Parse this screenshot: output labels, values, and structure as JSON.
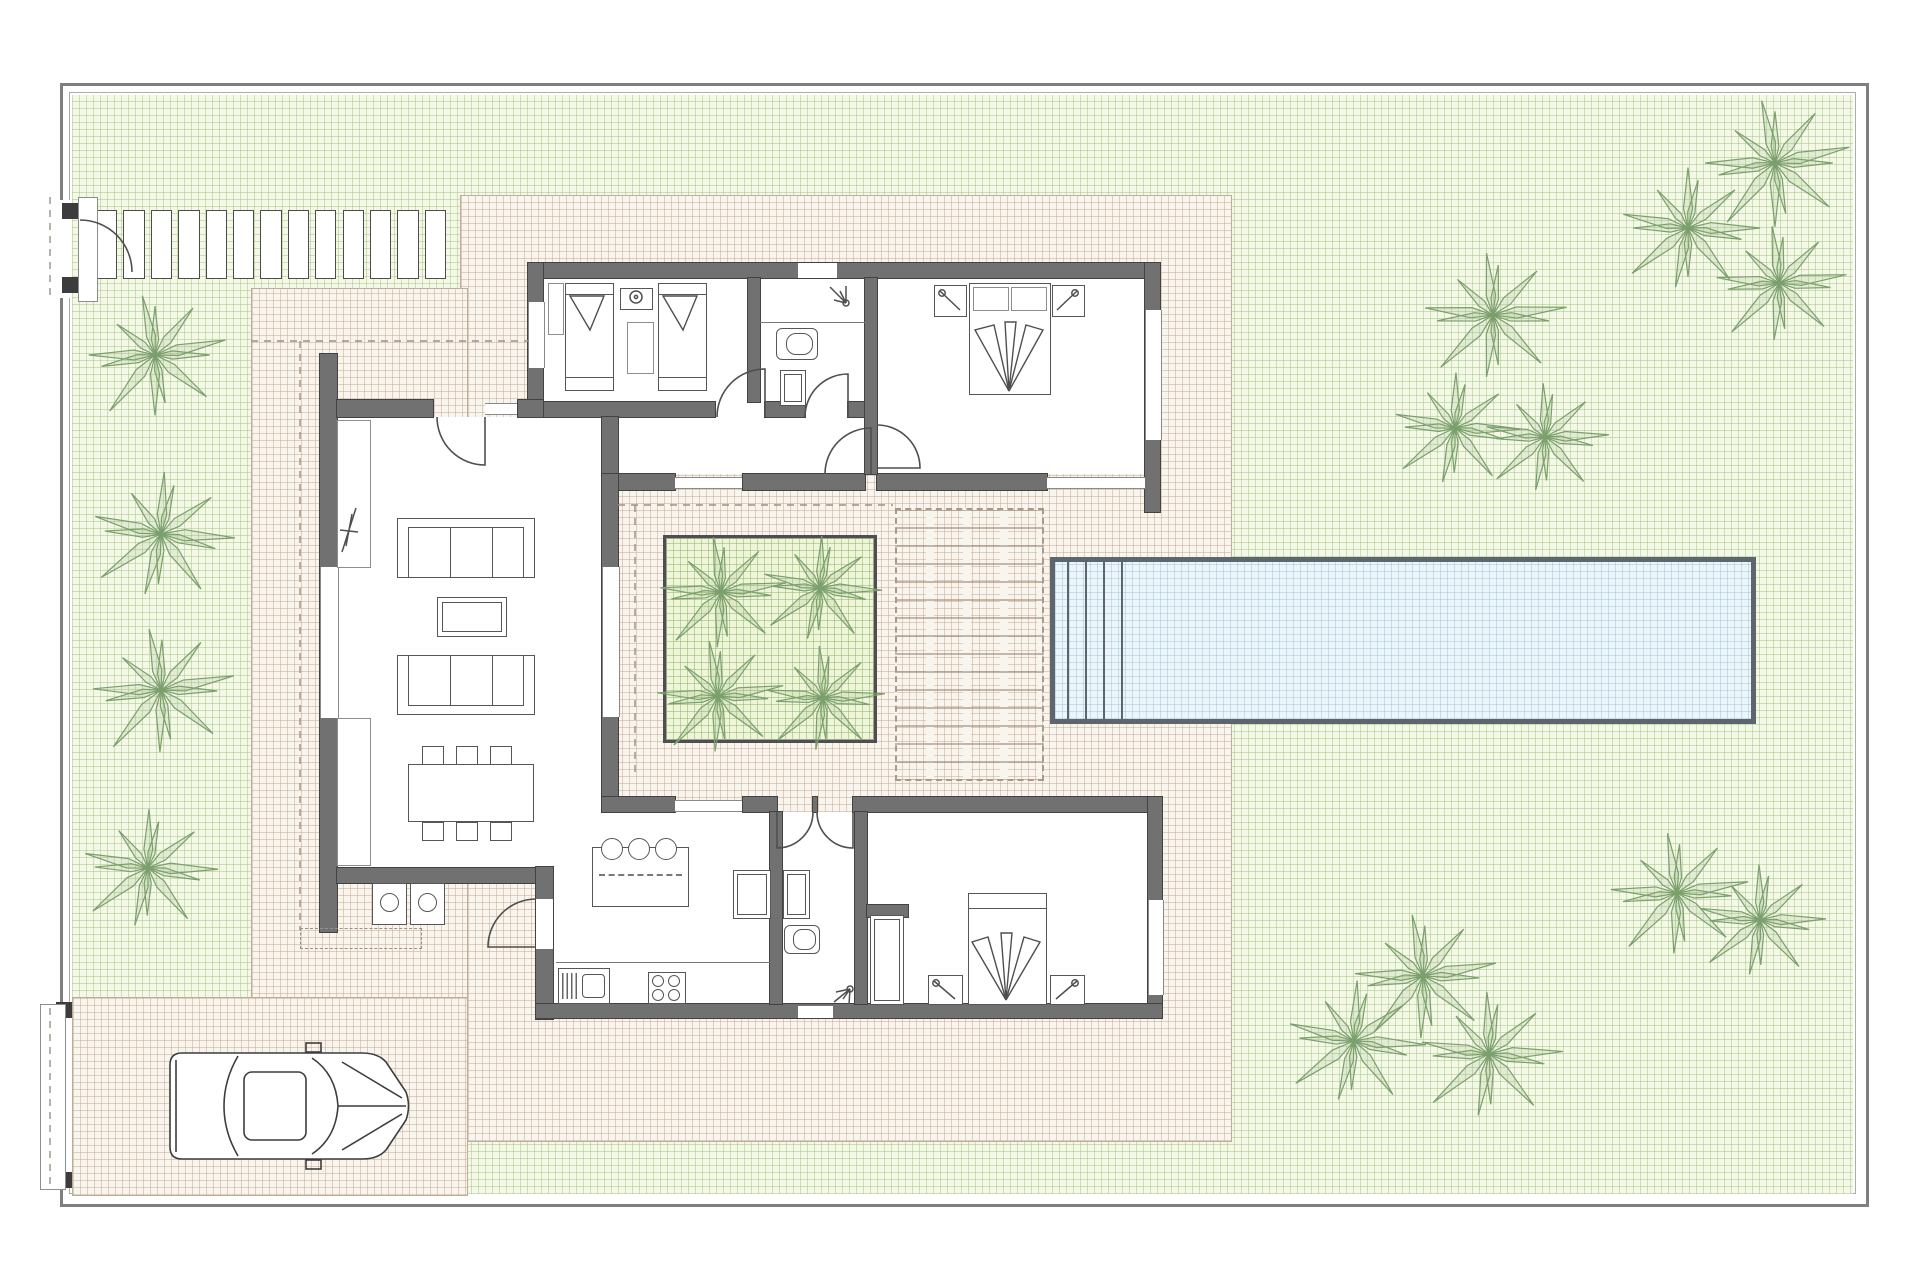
{
  "plan": {
    "type": "villa-floor-plan-site-drawing",
    "canvas": {
      "width": 1920,
      "height": 1280
    },
    "colors": {
      "wall": "#717171",
      "wall_edge": "#424242",
      "garden_bg": "#f4f8e9",
      "garden_line": "#9ebe70",
      "paved_bg": "#f8f4ee",
      "paved_line": "#c6a88c",
      "pool_water": "#ecf6fa",
      "pool_border": "#5d666e",
      "palm_stroke": "#7b9f6d",
      "palm_fill": "rgba(134,168,110,0.16)",
      "property_border": "#7f7f7f",
      "line": "#565656"
    },
    "walkway": {
      "slat_count": 13,
      "x": 96,
      "y": 210,
      "width": 356,
      "height": 67
    },
    "pool": {
      "x": 1050,
      "y": 557,
      "width": 706,
      "height": 167,
      "step_lines": 4,
      "steps_x": [
        1067,
        1085,
        1103,
        1121
      ]
    },
    "garden_palms": [
      [
        155,
        355,
        72
      ],
      [
        161,
        534,
        74
      ],
      [
        161,
        690,
        74
      ],
      [
        148,
        868,
        70
      ],
      [
        1775,
        163,
        76
      ],
      [
        1688,
        228,
        72
      ],
      [
        1779,
        283,
        68
      ],
      [
        1493,
        315,
        74
      ],
      [
        1455,
        428,
        66
      ],
      [
        1545,
        437,
        64
      ],
      [
        1677,
        893,
        72
      ],
      [
        1760,
        920,
        66
      ],
      [
        1423,
        976,
        74
      ],
      [
        1354,
        1041,
        72
      ],
      [
        1489,
        1054,
        74
      ]
    ],
    "planter_palms": [
      [
        721,
        592,
        66
      ],
      [
        820,
        588,
        62
      ],
      [
        718,
        696,
        66
      ],
      [
        823,
        698,
        62
      ]
    ],
    "car": {
      "x": 166,
      "y": 1051,
      "width": 248,
      "height": 110
    },
    "counts": {
      "bedrooms": 3,
      "bathrooms": 2,
      "sofas": 2,
      "dining_chairs": 6,
      "island_stools": 3,
      "washers": 2
    }
  }
}
